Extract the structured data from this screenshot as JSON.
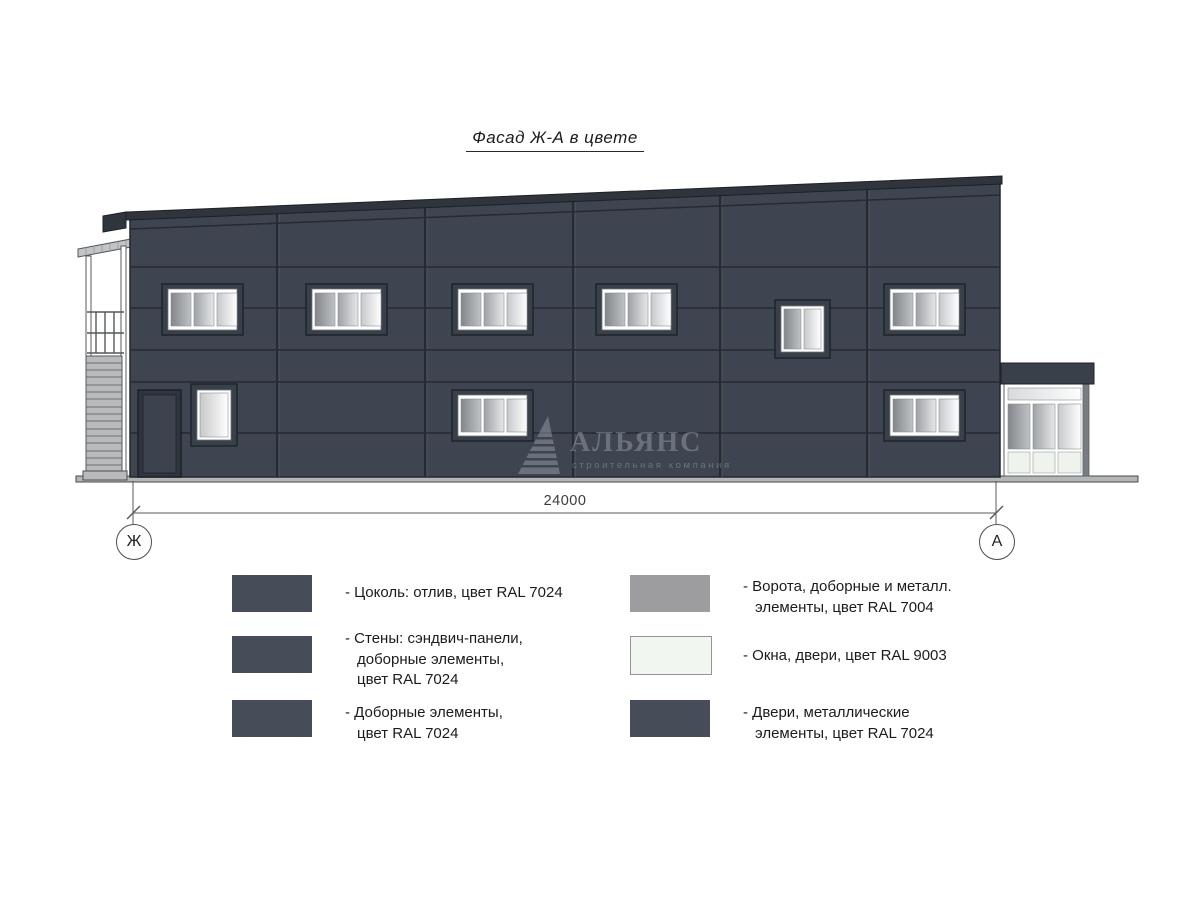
{
  "title": "Фасад Ж-А в цвете",
  "watermark": {
    "name": "АЛЬЯНС",
    "subtitle": "строительная компания"
  },
  "dimension": {
    "value": "24000"
  },
  "axes": {
    "left": "Ж",
    "right": "А"
  },
  "legend": {
    "items": [
      {
        "swatch_color": "#464d58",
        "lines": [
          "- Цоколь: отлив, цвет RAL 7024"
        ]
      },
      {
        "swatch_color": "#464d58",
        "lines": [
          "- Стены: сэндвич-панели,",
          "доборные элементы,",
          "цвет RAL 7024"
        ]
      },
      {
        "swatch_color": "#464d58",
        "lines": [
          "- Доборные элементы,",
          "цвет RAL 7024"
        ]
      },
      {
        "swatch_color": "#9d9da0",
        "lines": [
          "- Ворота, доборные и металл.",
          "элементы, цвет RAL 7004"
        ]
      },
      {
        "swatch_color": "#f1f6f1",
        "lines": [
          "- Окна, двери, цвет RAL 9003"
        ]
      },
      {
        "swatch_color": "#464d58",
        "lines": [
          "- Двери, металлические",
          "элементы, цвет RAL 7024"
        ]
      }
    ]
  },
  "colors": {
    "wall": "#3e4450",
    "panel_joint": "#262a31",
    "roof": "#2f343d",
    "window_surround": "#394049",
    "window_frame": "#ffffff",
    "ground": "#b4b5b7",
    "stair": "#b9babc",
    "legend_dark_ral7024": "#464d58",
    "legend_gray_ral7004": "#9d9da0",
    "legend_white_ral9003": "#f1f6f1"
  }
}
